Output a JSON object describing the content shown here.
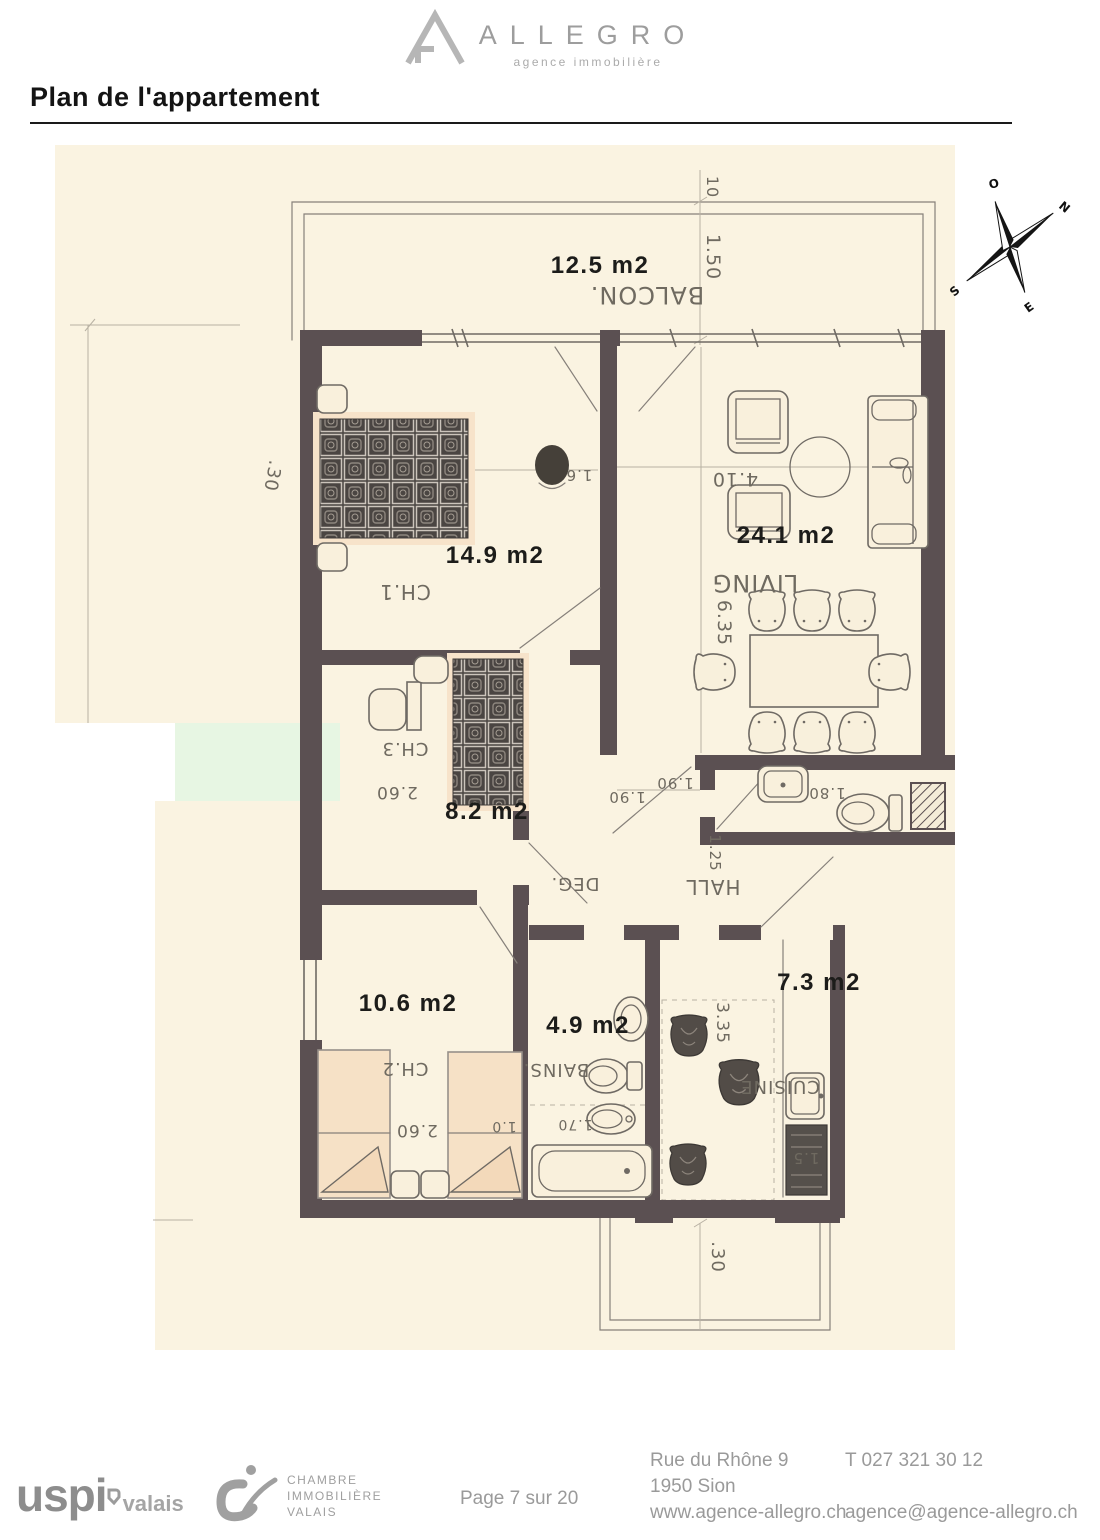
{
  "header": {
    "logo_text": "ALLEGRO",
    "logo_tagline": "agence immobilière",
    "title": "Plan de l'appartement"
  },
  "compass": {
    "west": "O",
    "north": "N",
    "east": "E",
    "south": "S"
  },
  "colors": {
    "wall": "#5b5052",
    "scan_background": "#faf3e1",
    "redaction_green": "#e7f6e3",
    "handwriting": "#6f6a60",
    "area_label": "#1c1c1a"
  },
  "floorplan": {
    "area_labels": [
      {
        "name": "balcony-area",
        "text": "12.5 m2",
        "x": 545,
        "y": 128
      },
      {
        "name": "bedroom1-area",
        "text": "14.9 m2",
        "x": 440,
        "y": 418
      },
      {
        "name": "living-area",
        "text": "24.1 m2",
        "x": 731,
        "y": 398
      },
      {
        "name": "bedroom3-area",
        "text": "8.2 m2",
        "x": 432,
        "y": 674
      },
      {
        "name": "bedroom2-area",
        "text": "10.6 m2",
        "x": 353,
        "y": 866
      },
      {
        "name": "bath-area",
        "text": "4.9 m2",
        "x": 533,
        "y": 888
      },
      {
        "name": "kitchen-area",
        "text": "7.3 m2",
        "x": 764,
        "y": 845
      }
    ],
    "handwritten_labels": [
      {
        "name": "balcony-name",
        "text": "BALCON.",
        "x": 592,
        "y": 142,
        "rot": 180,
        "size": 24
      },
      {
        "name": "bedroom1-name",
        "text": "CH.1",
        "x": 350,
        "y": 440,
        "rot": 180,
        "size": 20
      },
      {
        "name": "living-name",
        "text": "LIVING",
        "x": 700,
        "y": 430,
        "rot": 180,
        "size": 24
      },
      {
        "name": "bedroom3-name",
        "text": "CH.3",
        "x": 350,
        "y": 598,
        "rot": 180,
        "size": 18
      },
      {
        "name": "degagement-name",
        "text": "DEG.",
        "x": 520,
        "y": 733,
        "rot": 180,
        "size": 18
      },
      {
        "name": "hall-name",
        "text": "HALL",
        "x": 658,
        "y": 735,
        "rot": 180,
        "size": 20
      },
      {
        "name": "bedroom2-name",
        "text": "CH.2",
        "x": 350,
        "y": 918,
        "rot": 180,
        "size": 18
      },
      {
        "name": "bath-name",
        "text": "BAINS.",
        "x": 501,
        "y": 919,
        "rot": 180,
        "size": 18
      },
      {
        "name": "kitchen-name",
        "text": "CUISINE",
        "x": 725,
        "y": 936,
        "rot": 180,
        "size": 18
      }
    ],
    "dimension_labels": [
      {
        "text": "10",
        "x": 652,
        "y": 42,
        "rot": 90,
        "size": 16
      },
      {
        "text": "1.50",
        "x": 652,
        "y": 112,
        "rot": 90,
        "size": 19
      },
      {
        "text": ".30",
        "x": 212,
        "y": 330,
        "rot": 100,
        "size": 18
      },
      {
        "text": "1.6",
        "x": 524,
        "y": 325,
        "rot": 180,
        "size": 15
      },
      {
        "text": "4.10",
        "x": 680,
        "y": 328,
        "rot": 180,
        "size": 19
      },
      {
        "text": "6.35",
        "x": 663,
        "y": 478,
        "rot": 90,
        "size": 19
      },
      {
        "text": "2.60",
        "x": 342,
        "y": 642,
        "rot": 180,
        "size": 17
      },
      {
        "text": "1.90",
        "x": 572,
        "y": 647,
        "rot": 180,
        "size": 15
      },
      {
        "text": "1.90",
        "x": 620,
        "y": 633,
        "rot": 180,
        "size": 15
      },
      {
        "text": "1.25",
        "x": 655,
        "y": 708,
        "rot": 90,
        "size": 15
      },
      {
        "text": "1.80",
        "x": 772,
        "y": 643,
        "rot": 180,
        "size": 15
      },
      {
        "text": "2.60",
        "x": 362,
        "y": 980,
        "rot": 180,
        "size": 17
      },
      {
        "text": "1.0",
        "x": 449,
        "y": 977,
        "rot": 180,
        "size": 14
      },
      {
        "text": "1.70",
        "x": 520,
        "y": 975,
        "rot": 180,
        "size": 14
      },
      {
        "text": "3.35",
        "x": 662,
        "y": 878,
        "rot": 90,
        "size": 17
      },
      {
        "text": "1.5",
        "x": 751,
        "y": 1008,
        "rot": 180,
        "size": 15
      },
      {
        "text": ".30",
        "x": 657,
        "y": 1112,
        "rot": 90,
        "size": 18
      }
    ]
  },
  "footer": {
    "uspi_logo": {
      "main": "uspi",
      "region": "valais"
    },
    "ci_logo": {
      "lines": [
        "CHAMBRE",
        "IMMOBILIÈRE",
        "VALAIS"
      ]
    },
    "page_indicator": "Page 7 sur 20",
    "address_lines": [
      "Rue du Rhône 9",
      "1950 Sion",
      "www.agence-allegro.ch"
    ],
    "contact_lines": [
      "T 027 321 30 12",
      "agence@agence-allegro.ch"
    ]
  }
}
